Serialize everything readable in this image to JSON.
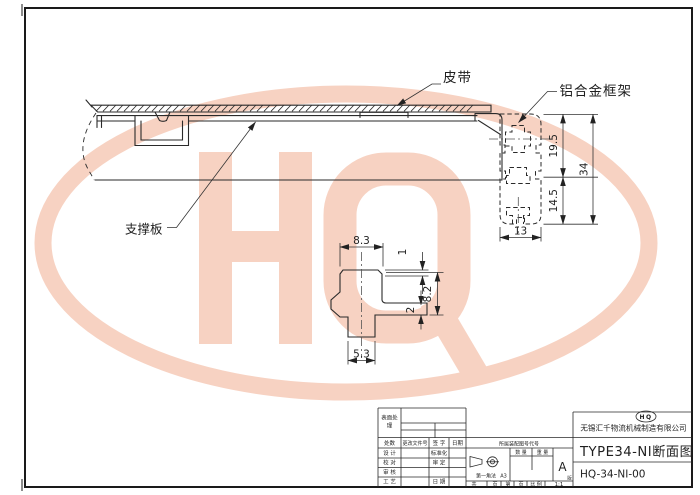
{
  "watermark": {
    "text": "HQ",
    "color": "#f7d2c2"
  },
  "labels": {
    "belt": "皮带",
    "frame": "铝合金框架",
    "support": "支撑板"
  },
  "dims": {
    "h_top": "19.5",
    "h_bottom": "14.5",
    "h_total": "34",
    "w_profile": "13"
  },
  "detail": {
    "top_w": "8.3",
    "lip": "1",
    "height": "8.2",
    "shelf": "2",
    "stem_w": "5.3"
  },
  "title_block": {
    "surface_line1": "表面处",
    "surface_line2": "理",
    "rev": {
      "count": "处数",
      "doc": "更改文件号",
      "sign": "签 字",
      "date": "日期"
    },
    "rows": {
      "design": "设 计",
      "standard": "标准化",
      "check": "校 对",
      "approve": "审 定",
      "review": "审 核",
      "craft": "工 艺",
      "date": "日 期"
    },
    "belongs": "所属装配图号代号",
    "first_angle": "第一角法",
    "paper": "A3",
    "qty": "数 量",
    "weight": "重 量",
    "rev_mark": "A",
    "rev_label": "版",
    "total": "共",
    "page1": "页",
    "sheet": "第",
    "page2": "页",
    "scale_label": "比 例",
    "scale": "1:1",
    "logo": "HQ",
    "company": "无锡汇千物流机械制造有限公司",
    "title": "TYPE34-NI断面图",
    "code": "HQ-34-NI-00"
  }
}
